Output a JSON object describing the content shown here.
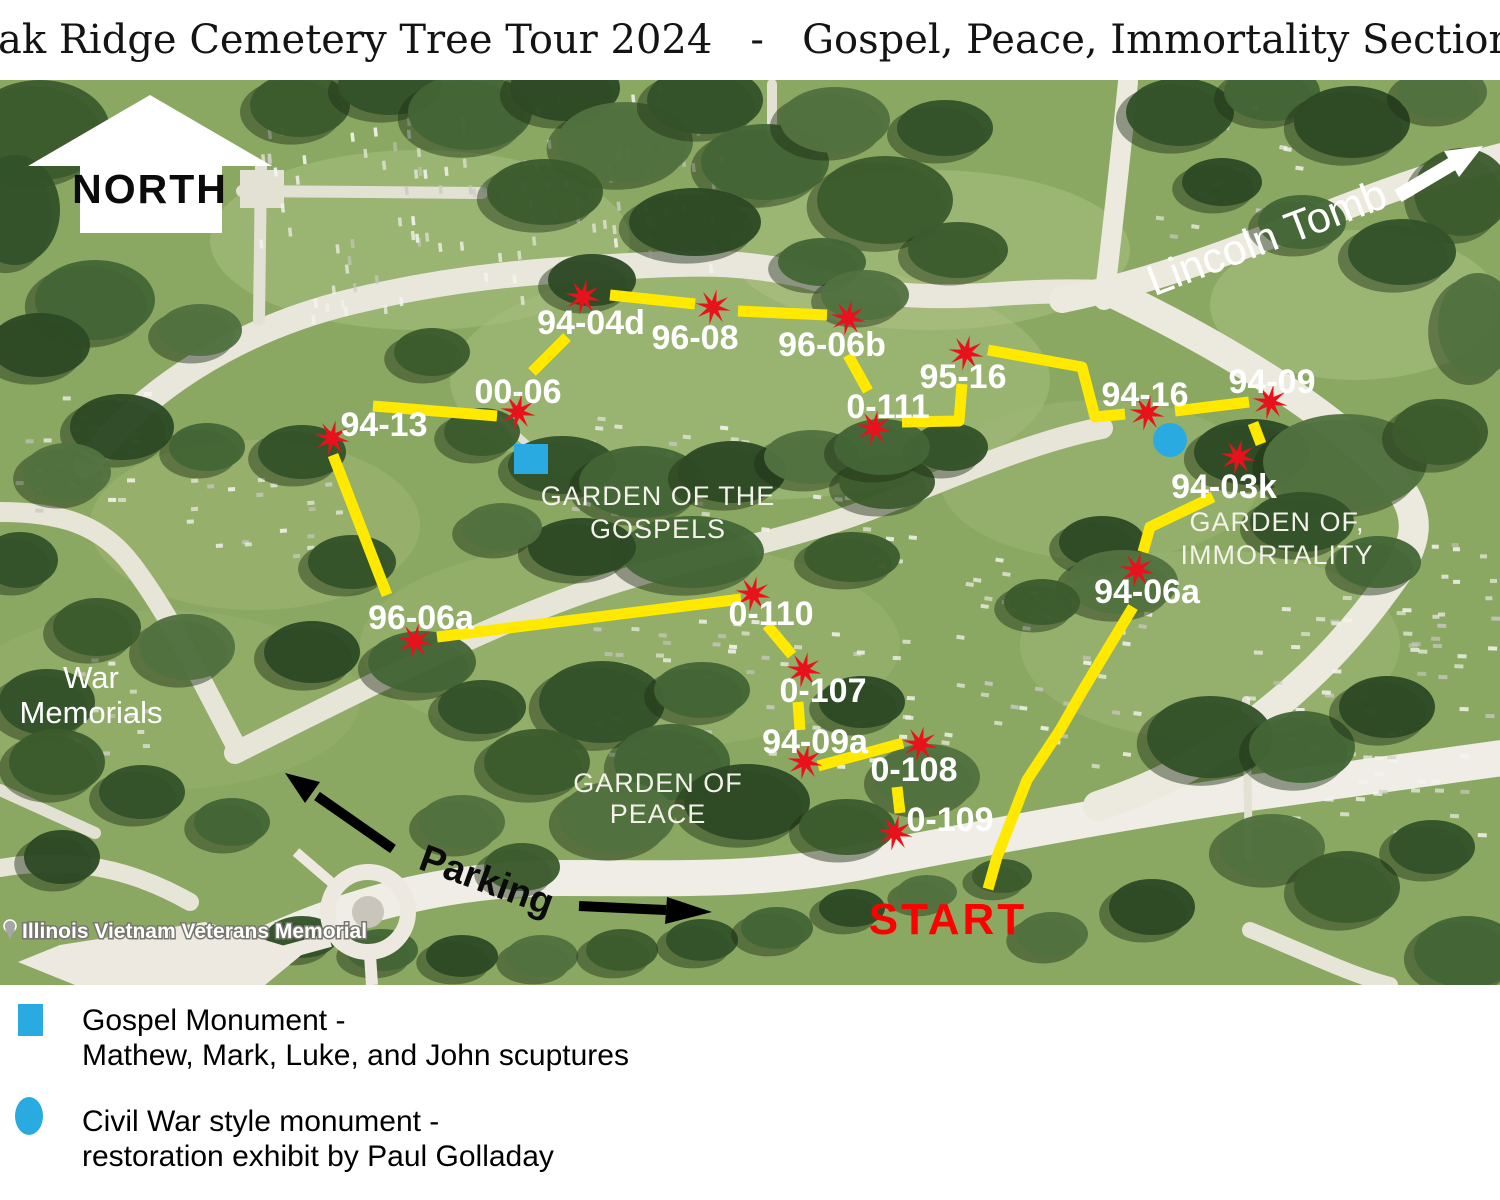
{
  "title": "Oak Ridge Cemetery Tree Tour 2024   -   Gospel, Peace, Immortality Sections",
  "map": {
    "north_arrow_label": "NORTH",
    "lincoln_tomb_label": "Lincoln Tomb",
    "parking_label": "Parking",
    "start_label": "START",
    "war_memorials_lines": [
      "War",
      "Memorials"
    ],
    "vietnam_memorial_label": "Illinois Vietnam Veterans Memorial",
    "colors": {
      "route_yellow": "#ffe900",
      "marker_red": "#e8121c",
      "monument_blue": "#29abe2",
      "start_red": "#ff0000"
    },
    "sections": [
      {
        "name": "garden-of-the-gospels",
        "lines": [
          "GARDEN OF THE",
          "GOSPELS"
        ],
        "x": 658,
        "y": 505,
        "line_gap": 33
      },
      {
        "name": "garden-of-peace",
        "lines": [
          "GARDEN OF",
          "PEACE"
        ],
        "x": 658,
        "y": 792,
        "line_gap": 31
      },
      {
        "name": "garden-of-immortality",
        "lines": [
          "GARDEN OF,",
          "IMMORTALITY"
        ],
        "x": 1277,
        "y": 531,
        "line_gap": 33
      }
    ],
    "tree_stops": [
      {
        "label": "94-04d",
        "star": [
          583,
          297
        ],
        "text": [
          591,
          322
        ]
      },
      {
        "label": "96-08",
        "star": [
          713,
          307
        ],
        "text": [
          695,
          337
        ]
      },
      {
        "label": "96-06b",
        "star": [
          848,
          318
        ],
        "text": [
          832,
          344
        ]
      },
      {
        "label": "95-16",
        "star": [
          966,
          353
        ],
        "text": [
          963,
          376
        ]
      },
      {
        "label": "0-111",
        "star": [
          874,
          428
        ],
        "text": [
          888,
          406
        ]
      },
      {
        "label": "00-06",
        "star": [
          518,
          412
        ],
        "text": [
          518,
          391
        ]
      },
      {
        "label": "94-13",
        "star": [
          332,
          438
        ],
        "text": [
          384,
          424
        ]
      },
      {
        "label": "96-06a",
        "star": [
          415,
          641
        ],
        "text": [
          421,
          617
        ]
      },
      {
        "label": "0-110",
        "star": [
          753,
          594
        ],
        "text": [
          771,
          613
        ]
      },
      {
        "label": "0-107",
        "star": [
          804,
          670
        ],
        "text": [
          823,
          690
        ]
      },
      {
        "label": "94-09a",
        "star": [
          805,
          762
        ],
        "text": [
          815,
          741
        ]
      },
      {
        "label": "0-108",
        "star": [
          920,
          744
        ],
        "text": [
          914,
          769
        ]
      },
      {
        "label": "0-109",
        "star": [
          895,
          833
        ],
        "text": [
          950,
          819
        ]
      },
      {
        "label": "94-06a",
        "star": [
          1137,
          570
        ],
        "text": [
          1147,
          591
        ]
      },
      {
        "label": "94-03k",
        "star": [
          1238,
          457
        ],
        "text": [
          1224,
          486
        ]
      },
      {
        "label": "94-16",
        "star": [
          1147,
          413
        ],
        "text": [
          1145,
          394
        ]
      },
      {
        "label": "94-09",
        "star": [
          1270,
          402
        ],
        "text": [
          1272,
          381
        ]
      }
    ],
    "route_segments": [
      [
        [
          333,
          455
        ],
        [
          387,
          595
        ]
      ],
      [
        [
          437,
          637
        ],
        [
          741,
          599
        ]
      ],
      [
        [
          373,
          406
        ],
        [
          497,
          416
        ]
      ],
      [
        [
          532,
          372
        ],
        [
          567,
          337
        ]
      ],
      [
        [
          610,
          295
        ],
        [
          695,
          304
        ]
      ],
      [
        [
          738,
          311
        ],
        [
          827,
          315
        ]
      ],
      [
        [
          848,
          355
        ],
        [
          868,
          391
        ]
      ],
      [
        [
          902,
          422
        ],
        [
          959,
          421
        ],
        [
          962,
          384
        ]
      ],
      [
        [
          988,
          350
        ],
        [
          1082,
          367
        ],
        [
          1095,
          417
        ],
        [
          1125,
          414
        ]
      ],
      [
        [
          1175,
          411
        ],
        [
          1249,
          402
        ]
      ],
      [
        [
          1253,
          423
        ],
        [
          1261,
          444
        ]
      ],
      [
        [
          1213,
          497
        ],
        [
          1150,
          527
        ],
        [
          1143,
          552
        ]
      ],
      [
        [
          1133,
          607
        ],
        [
          1083,
          690
        ],
        [
          1060,
          730
        ],
        [
          1027,
          780
        ],
        [
          997,
          857
        ],
        [
          988,
          889
        ]
      ],
      [
        [
          767,
          625
        ],
        [
          792,
          655
        ]
      ],
      [
        [
          798,
          702
        ],
        [
          800,
          730
        ]
      ],
      [
        [
          818,
          766
        ],
        [
          903,
          743
        ]
      ],
      [
        [
          897,
          787
        ],
        [
          900,
          813
        ]
      ]
    ],
    "monuments": {
      "gospel_square": {
        "x": 514,
        "y": 444,
        "width": 34,
        "height": 30
      },
      "civil_war_circle": {
        "cx": 1170,
        "cy": 440,
        "r": 17
      }
    }
  },
  "legend": {
    "items": [
      {
        "symbol": "square",
        "lines": [
          "Gospel Monument -",
          "Mathew, Mark, Luke, and John scuptures"
        ]
      },
      {
        "symbol": "circle",
        "lines": [
          "Civil War style monument -",
          "restoration exhibit by Paul Golladay"
        ]
      }
    ]
  }
}
